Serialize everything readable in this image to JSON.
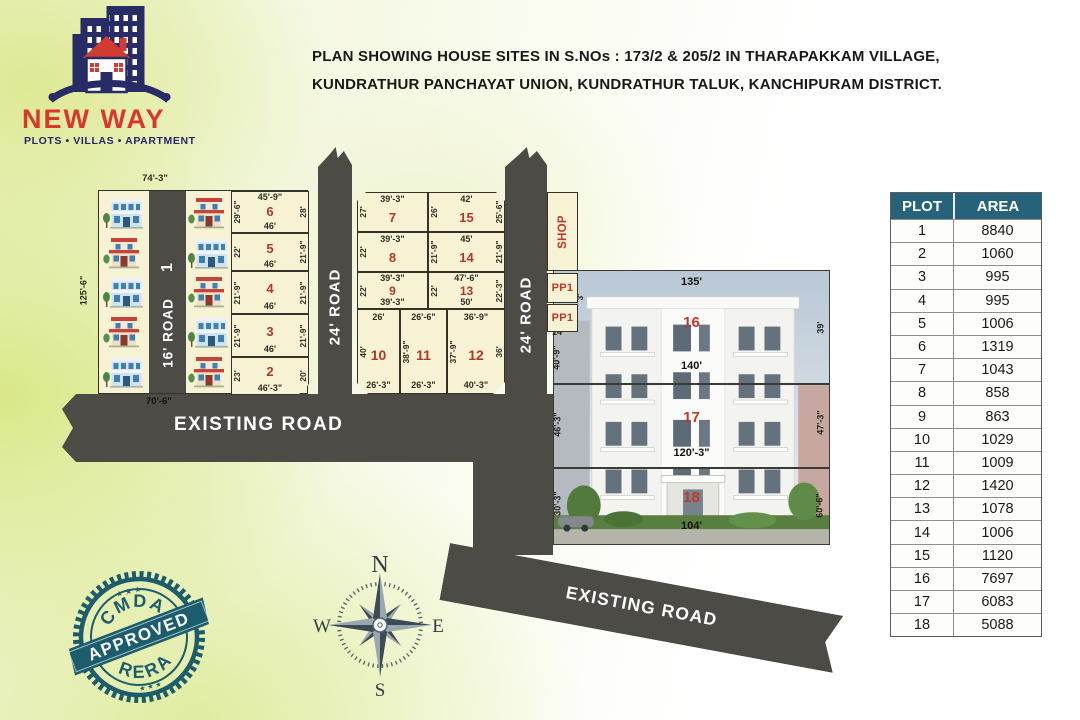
{
  "title": {
    "line1": "PLAN SHOWING HOUSE SITES IN S.NOs : 173/2 & 205/2 IN THARAPAKKAM VILLAGE,",
    "line2": "KUNDRATHUR PANCHAYAT UNION, KUNDRATHUR TALUK, KANCHIPURAM DISTRICT."
  },
  "logo": {
    "name": "NEW WAY",
    "tagline": "PLOTS • VILLAS • APARTMENT"
  },
  "stamp": {
    "arc_top": "CMDA",
    "banner": "APPROVED",
    "arc_bottom": "RERA",
    "stars_top": "★ ★ ★",
    "stars_bottom": "★ ★ ★"
  },
  "compass": {
    "north": "N",
    "east": "E",
    "south": "S",
    "west": "W"
  },
  "roads": {
    "plot1_no": "1",
    "road16": "16' ROAD",
    "road24_left": "24' ROAD",
    "road24_right": "24' ROAD",
    "existing_bottom": "EXISTING ROAD",
    "existing_diagonal": "EXISTING ROAD"
  },
  "outer_dims": {
    "block1_top": "74'-3\"",
    "block1_left": "125'-6\"",
    "block1_bottom": "70'-6\""
  },
  "special": {
    "shop": "SHOP",
    "pp1_a": "PP1",
    "pp1_b": "PP1",
    "pp_dim": "3'"
  },
  "plots": {
    "p2": {
      "num": "2",
      "left": "23'",
      "right": "20'",
      "bottom": "46'-3\""
    },
    "p3": {
      "num": "3",
      "left": "21'-9\"",
      "right": "21'-9\"",
      "bottom": "46'"
    },
    "p4": {
      "num": "4",
      "left": "21'-9\"",
      "right": "21'-9\"",
      "bottom": "46'"
    },
    "p5": {
      "num": "5",
      "left": "22'",
      "right": "21'-9\"",
      "bottom": "46'"
    },
    "p6": {
      "num": "6",
      "top": "45'-9\"",
      "left": "29'-6\"",
      "right": "28'",
      "bottom": "46'"
    },
    "p7": {
      "num": "7",
      "top": "39'-3\"",
      "left": "27'"
    },
    "p8": {
      "num": "8",
      "top": "39'-3\"",
      "left": "22'"
    },
    "p9": {
      "num": "9",
      "top": "39'-3\"",
      "left": "22'",
      "bottom": "39'-3\""
    },
    "p10": {
      "num": "10",
      "top": "26'",
      "left": "40'",
      "bottom": "26'-3\""
    },
    "p11": {
      "num": "11",
      "top": "26'-6\"",
      "left": "38'-9\"",
      "bottom": "26'-3\""
    },
    "p12": {
      "num": "12",
      "top": "36'-9\"",
      "left": "37'-9\"",
      "right": "36'",
      "bottom": "40'-3\""
    },
    "p13": {
      "num": "13",
      "top": "47'-6\"",
      "left": "22'",
      "right": "22'-3\"",
      "bottom": "50'"
    },
    "p14": {
      "num": "14",
      "top": "45'",
      "left": "21'-9\"",
      "right": "21'-9\""
    },
    "p15": {
      "num": "15",
      "top": "42'",
      "left": "26'",
      "right": "25'-6\""
    },
    "p16": {
      "num": "16",
      "top": "135'",
      "bottom": "140'",
      "left_a": "14'",
      "left_b": "40'-9\"",
      "right": "39'"
    },
    "p17": {
      "num": "17",
      "bottom": "120'-3\"",
      "left": "46'-3\"",
      "right": "47'-3\""
    },
    "p18": {
      "num": "18",
      "bottom": "104'",
      "left": "30'-3\"",
      "right": "60'-6\""
    }
  },
  "table": {
    "headers": [
      "PLOT",
      "AREA"
    ],
    "rows": [
      [
        "1",
        "8840"
      ],
      [
        "2",
        "1060"
      ],
      [
        "3",
        "995"
      ],
      [
        "4",
        "995"
      ],
      [
        "5",
        "1006"
      ],
      [
        "6",
        "1319"
      ],
      [
        "7",
        "1043"
      ],
      [
        "8",
        "858"
      ],
      [
        "9",
        "863"
      ],
      [
        "10",
        "1029"
      ],
      [
        "11",
        "1009"
      ],
      [
        "12",
        "1420"
      ],
      [
        "13",
        "1078"
      ],
      [
        "14",
        "1006"
      ],
      [
        "15",
        "1120"
      ],
      [
        "16",
        "7697"
      ],
      [
        "17",
        "6083"
      ],
      [
        "18",
        "5088"
      ]
    ]
  }
}
